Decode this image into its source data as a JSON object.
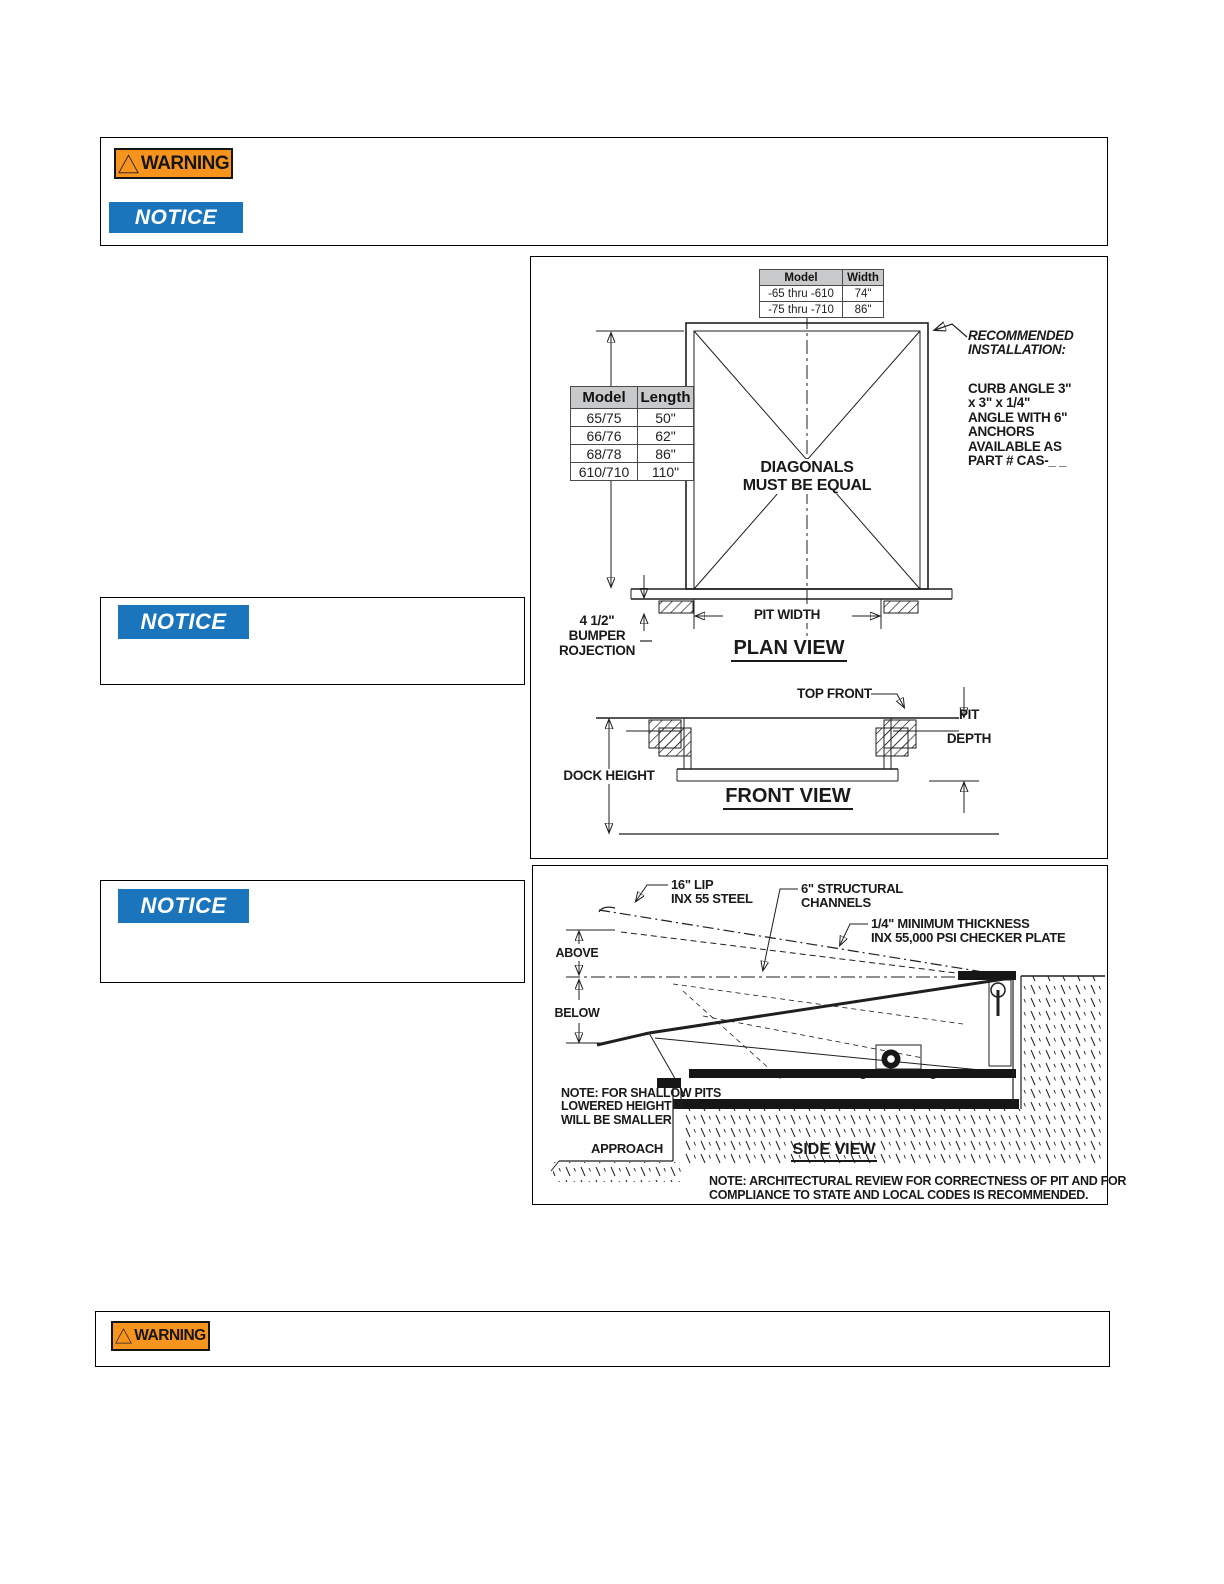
{
  "colors": {
    "warning_orange": "#F7941D",
    "notice_blue": "#1B75BC",
    "table_header_gray": "#C8C9CA",
    "line_black": "#1a1a1a"
  },
  "badges": {
    "warning_label": "WARNING",
    "notice_label": "NOTICE",
    "warning_icon": "warning-triangle-icon"
  },
  "plan_view": {
    "width_table": {
      "headers": [
        "Model",
        "Width"
      ],
      "rows": [
        [
          "-65 thru -610",
          "74\""
        ],
        [
          "-75 thru -710",
          "86\""
        ]
      ]
    },
    "length_table": {
      "headers": [
        "Model",
        "Length"
      ],
      "rows": [
        [
          "65/75",
          "50\""
        ],
        [
          "66/76",
          "62\""
        ],
        [
          "68/78",
          "86\""
        ],
        [
          "610/710",
          "110\""
        ]
      ]
    },
    "diagonals_line1": "DIAGONALS",
    "diagonals_line2": "MUST BE EQUAL",
    "recommended_line1": "RECOMMENDED",
    "recommended_line2": "INSTALLATION:",
    "curb_lines": [
      "CURB ANGLE 3\"",
      "x 3\" x 1/4\"",
      "ANGLE WITH 6\"",
      "ANCHORS",
      "AVAILABLE AS",
      "PART # CAS-_ _"
    ],
    "pit_width_label": "PIT WIDTH",
    "plan_title": "PLAN VIEW",
    "bumper_lines": [
      "4 1/2\"",
      "BUMPER",
      "ROJECTION"
    ],
    "top_front_label": "TOP FRONT",
    "pit_label": "PIT",
    "depth_label": "DEPTH",
    "dock_height_label": "DOCK HEIGHT",
    "front_title": "FRONT VIEW"
  },
  "side_view": {
    "lip_lines": [
      "16\" LIP",
      "INX 55 STEEL"
    ],
    "channels_lines": [
      "6\" STRUCTURAL",
      "CHANNELS"
    ],
    "plate_lines": [
      "1/4\" MINIMUM THICKNESS",
      "INX 55,000 PSI CHECKER PLATE"
    ],
    "above_label": "ABOVE",
    "below_label": "BELOW",
    "shallow_lines": [
      "NOTE: FOR SHALLOW PITS",
      "LOWERED HEIGHT",
      "WILL BE SMALLER"
    ],
    "approach_label": "APPROACH",
    "side_title": "SIDE VIEW",
    "arch_note_lines": [
      "NOTE: ARCHITECTURAL REVIEW FOR CORRECTNESS OF PIT AND FOR",
      "COMPLIANCE TO STATE AND LOCAL CODES IS RECOMMENDED."
    ]
  }
}
